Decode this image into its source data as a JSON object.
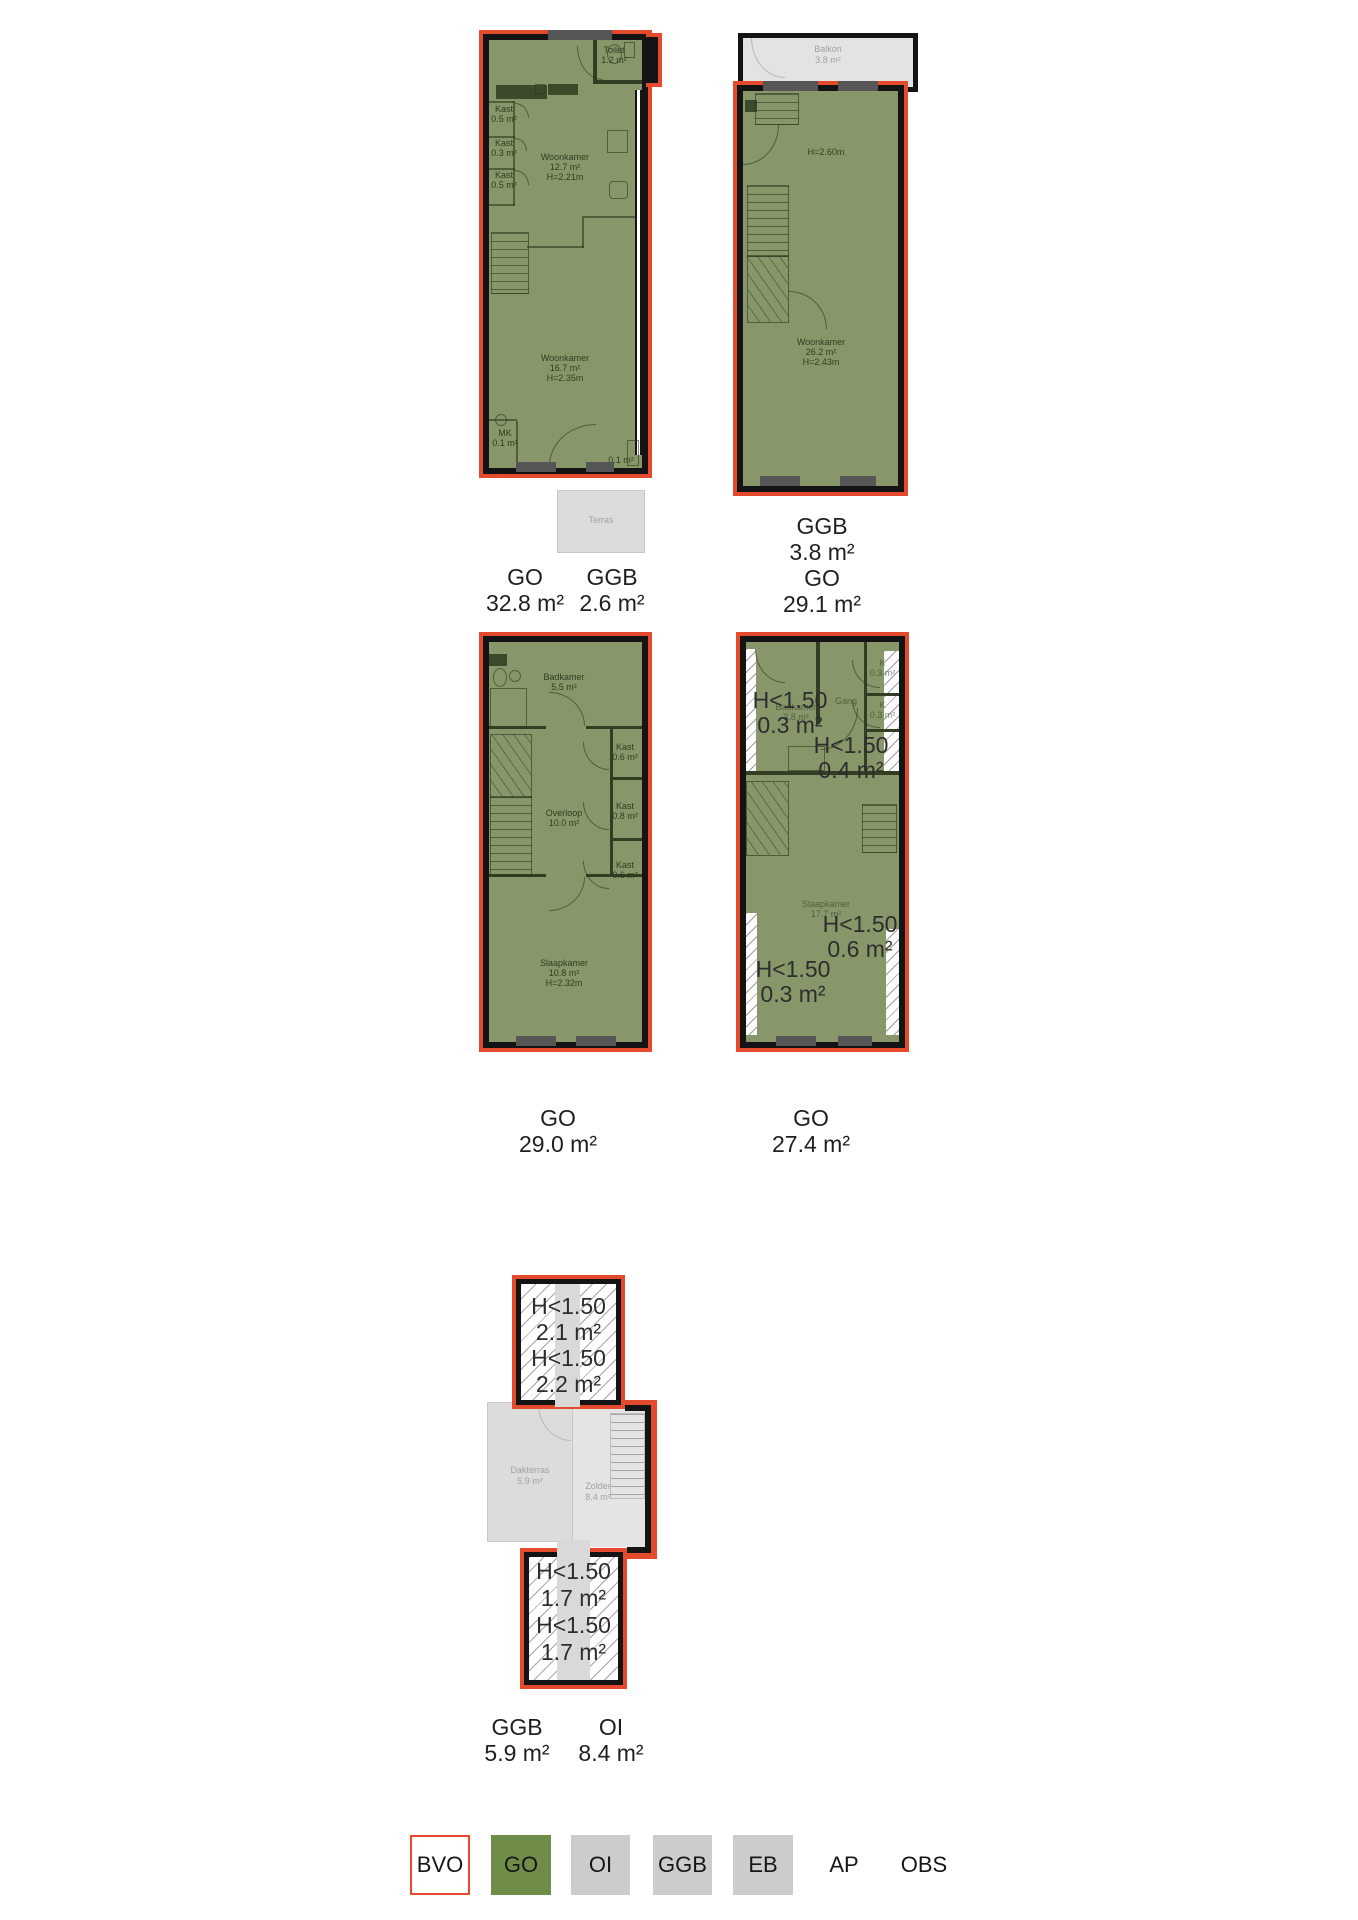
{
  "plans": [
    {
      "captions": [
        {
          "code": "GO",
          "area": "32.8 m²"
        },
        {
          "code": "GGB",
          "area": "2.6 m²"
        }
      ],
      "labels": {
        "toilet": {
          "name": "Toilet",
          "area": "1.2 m²"
        },
        "kast1": {
          "name": "Kast",
          "area": "0.5 m²"
        },
        "kast2": {
          "name": "Kast",
          "area": "0.3 m²"
        },
        "kast3": {
          "name": "Kast",
          "area": "0.5 m²"
        },
        "woonkamer1": {
          "name": "Woonkamer",
          "area": "12.7 m²",
          "height": "H=2.21m"
        },
        "woonkamer2": {
          "name": "Woonkamer",
          "area": "16.7 m²",
          "height": "H=2.35m"
        },
        "mk": {
          "name": "MK",
          "area": "0.1 m²"
        },
        "corner": {
          "area": "0.1 m²"
        },
        "terras": {
          "name": "Terras"
        }
      }
    },
    {
      "captions": [
        {
          "code": "GGB",
          "area": "3.8 m²"
        },
        {
          "code": "GO",
          "area": "29.1 m²"
        }
      ],
      "labels": {
        "balkon": {
          "name": "Balkon",
          "area": "3.8 m²"
        },
        "height_note": "H=2.60m",
        "woonkamer": {
          "name": "Woonkamer",
          "area": "26.2 m²",
          "height": "H=2.43m"
        }
      }
    },
    {
      "captions": [
        {
          "code": "GO",
          "area": "29.0 m²"
        }
      ],
      "labels": {
        "badkamer": {
          "name": "Badkamer",
          "area": "5.5 m²"
        },
        "kast1": {
          "name": "Kast",
          "area": "0.6 m²"
        },
        "kast2": {
          "name": "Kast",
          "area": "0.8 m²"
        },
        "kast3": {
          "name": "Kast",
          "area": "0.6 m²"
        },
        "overloop": {
          "name": "Overloop",
          "area": "10.0 m²"
        },
        "slaapkamer": {
          "name": "Slaapkamer",
          "area": "10.8 m²",
          "height": "H=2.32m"
        }
      }
    },
    {
      "captions": [
        {
          "code": "GO",
          "area": "27.4 m²"
        }
      ],
      "labels": {
        "gang": {
          "name": "Gang"
        },
        "k1": {
          "name": "K",
          "area": "0.3 m²"
        },
        "k2": {
          "name": "K",
          "area": "0.3 m²"
        },
        "badkamer": {
          "name": "Badkamer",
          "area": "3.8 m²"
        },
        "slaapkamer": {
          "name": "Slaapkamer",
          "area": "17.7 m²"
        }
      },
      "annotations": [
        {
          "label": "H<1.50",
          "area": "0.3 m²"
        },
        {
          "label": "H<1.50",
          "area": "0.4 m²"
        },
        {
          "label": "H<1.50",
          "area": "0.6 m²"
        },
        {
          "label": "H<1.50",
          "area": "0.3 m²"
        }
      ]
    },
    {
      "captions": [
        {
          "code": "GGB",
          "area": "5.9 m²"
        },
        {
          "code": "OI",
          "area": "8.4 m²"
        }
      ],
      "labels": {
        "dakterras": {
          "name": "Dakterras",
          "area": "5.9 m²"
        },
        "zolder": {
          "name": "Zolder",
          "area": "8.4 m²"
        }
      },
      "annotations_top": [
        {
          "label": "H<1.50",
          "area": "2.1 m²"
        },
        {
          "label": "H<1.50",
          "area": "2.2 m²"
        }
      ],
      "annotations_bottom": [
        {
          "label": "H<1.50",
          "area": "1.7 m²"
        },
        {
          "label": "H<1.50",
          "area": "1.7 m²"
        }
      ]
    }
  ],
  "legend": {
    "items": [
      {
        "label": "BVO",
        "fill": "#ffffff",
        "border": "#e34b2c"
      },
      {
        "label": "GO",
        "fill": "#6f8c49",
        "border": "#6f8c49"
      },
      {
        "label": "OI",
        "fill": "#cccccc",
        "border": "#cccccc"
      },
      {
        "label": "GGB",
        "fill": "#cccccc",
        "border": "#cccccc"
      },
      {
        "label": "EB",
        "fill": "#cccccc",
        "border": "#cccccc"
      },
      {
        "label": "AP",
        "fill": "",
        "border": ""
      },
      {
        "label": "OBS",
        "fill": "",
        "border": ""
      }
    ]
  },
  "colors": {
    "bvo_outline": "#e34b2c",
    "go_fill": "#87976a",
    "wall": "#141414",
    "outdoor_grey": "#dcdcdc"
  }
}
